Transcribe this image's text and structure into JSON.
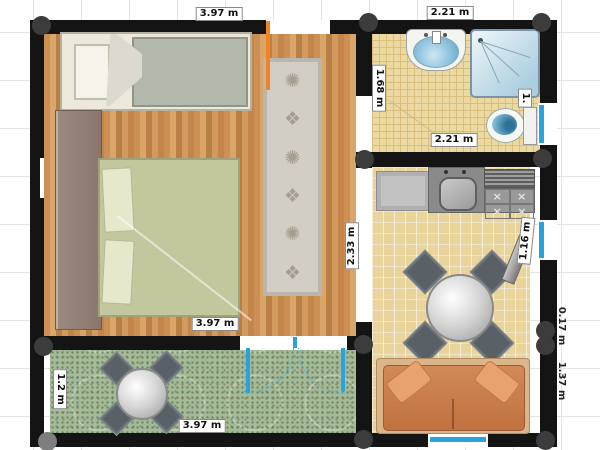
{
  "labels": {
    "top_left": "3.97 m",
    "top_right": "2.21 m",
    "bathroom_left": "1.68 m",
    "bathroom_window": "1.",
    "bathroom_bottom": "2.21 m",
    "middle_wall": "2.33 m",
    "bedroom_bottom": "3.97 m",
    "kitchen_window": "1.16 m",
    "patio_left": "1.2 m",
    "patio_bottom": "3.97 m",
    "right_upper": "0.17 m",
    "right_lower": "1.37 m"
  },
  "icons": {
    "rug_glyph_a": "✺",
    "rug_glyph_b": "❖",
    "burner_glyph": "×"
  },
  "colors": {
    "wall": "#141414",
    "window_blue": "#2aa3dd",
    "door_orange": "#f58220",
    "wood_floor": "#c98f52",
    "bathroom_tile": "#ecd9a2",
    "kitchen_tile": "#e9d49b",
    "patio_tile": "#a3bb98",
    "sofa_orange": "#c97f4f",
    "grid_line": "#e4e4e4"
  }
}
